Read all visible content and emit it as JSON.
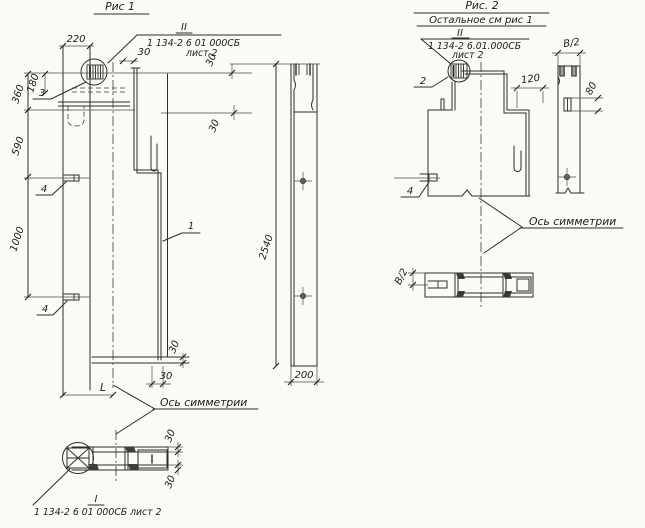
{
  "fig1": {
    "title": "Рис 1",
    "callout_top": {
      "roman": "II",
      "doc": "1 134-2 6 01 000СБ",
      "sheet": "лист 2"
    },
    "callout_bottom": {
      "roman": "I",
      "doc": "1 134-2 6 01 000СБ лист 2"
    },
    "axis_label": "Ось симметрии",
    "dims": {
      "d220": "220",
      "d180": "180",
      "d360": "360",
      "d590": "590",
      "d1000": "1000",
      "d30": "30",
      "dL": "L",
      "d2540": "2540",
      "d200": "200"
    },
    "labels": {
      "p1": "1",
      "p3": "3",
      "p4": "4"
    }
  },
  "fig2": {
    "title": "Рис. 2",
    "subtitle": "Остальное см рис 1",
    "callout_top": {
      "roman": "II",
      "doc": "1 134-2 6.01.000СБ",
      "sheet": "лист 2"
    },
    "axis_label": "Ось симметрии",
    "dims": {
      "d120": "120",
      "d80": "80",
      "dB2": "В/2"
    },
    "labels": {
      "p2": "2",
      "p4": "4"
    }
  }
}
